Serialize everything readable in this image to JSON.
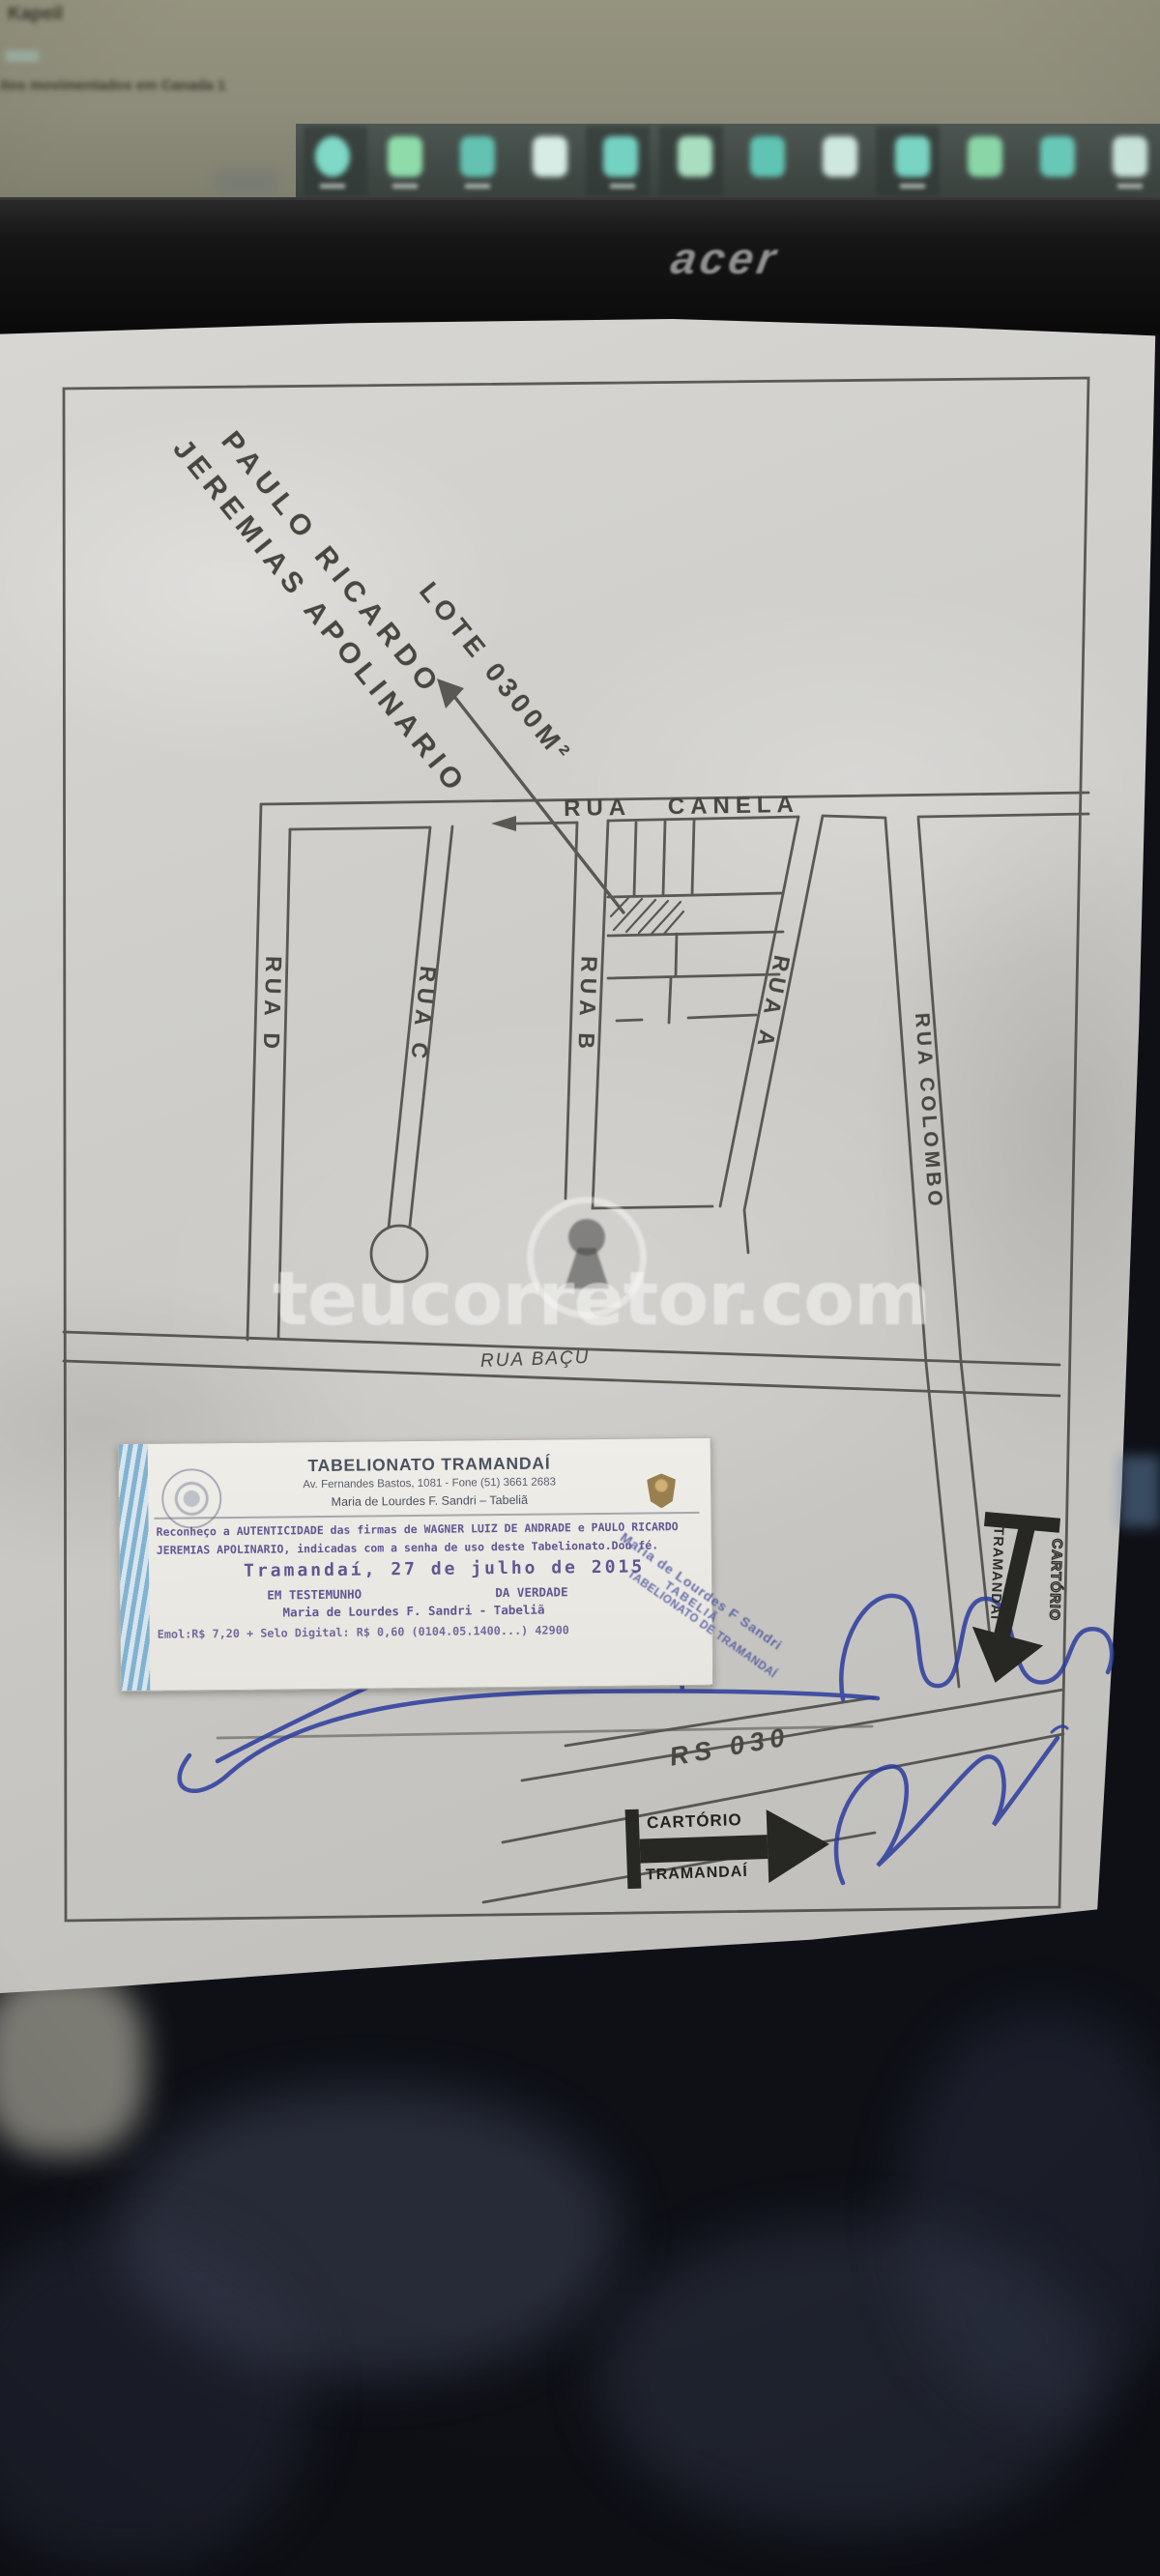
{
  "screen": {
    "line1": "Kapeil",
    "line2": "itos movimentados em Canada 1"
  },
  "laptop": {
    "brand": "acer"
  },
  "map": {
    "owner_line1": "PAULO RICARDO",
    "owner_line2": "JEREMIAS APOLINARIO",
    "lot_label": "LOTE 0300M²",
    "labels": {
      "canela": "RUA CANELA",
      "rua_d": "RUA D",
      "rua_c": "RUA C",
      "rua_b": "RUA B",
      "rua_a": "RUA A",
      "colombo": "RUA COLOMBO",
      "bacu": "RUA BAÇU",
      "rs030": "RS 030"
    }
  },
  "watermark": {
    "text": "teucorretor.com"
  },
  "notary_label": {
    "title": "TABELIONATO TRAMANDAÍ",
    "address": "Av. Fernandes Bastos, 1081 - Fone (51) 3661 2683",
    "officer": "Maria de Lourdes F. Sandri – Tabeliã",
    "body_line1": "Reconheço a AUTENTICIDADE das firmas de WAGNER LUIZ DE ANDRADE e PAULO RICARDO",
    "body_line2": "JEREMIAS APOLINARIO, indicadas com a senha de uso deste Tabelionato.Dou fé.",
    "date_line": "Tramandaí, 27 de julho de 2015",
    "witness_left": "EM TESTEMUNHO",
    "witness_right": "DA VERDADE",
    "signature_line": "Maria de Lourdes F. Sandri - Tabeliã",
    "fee_line": "Emol:R$ 7,20 + Selo Digital: R$ 0,60 (0104.05.1400...) 42900"
  },
  "diagonal_stamp": {
    "line1": "Maria de Lourdes F Sandri",
    "line2": "TABELIÃ",
    "line3": "TABELIONATO DE TRAMANDAÍ"
  },
  "arrow_stamp": {
    "line1": "CARTÓRIO",
    "line2": "TRAMANDAÍ"
  },
  "colors": {
    "pen_ink": "#45443f",
    "blue_ink": "#2c3c9e",
    "stamp_purple": "#564a8c",
    "stamp_black": "#272723",
    "paper": "#cbcac6"
  }
}
